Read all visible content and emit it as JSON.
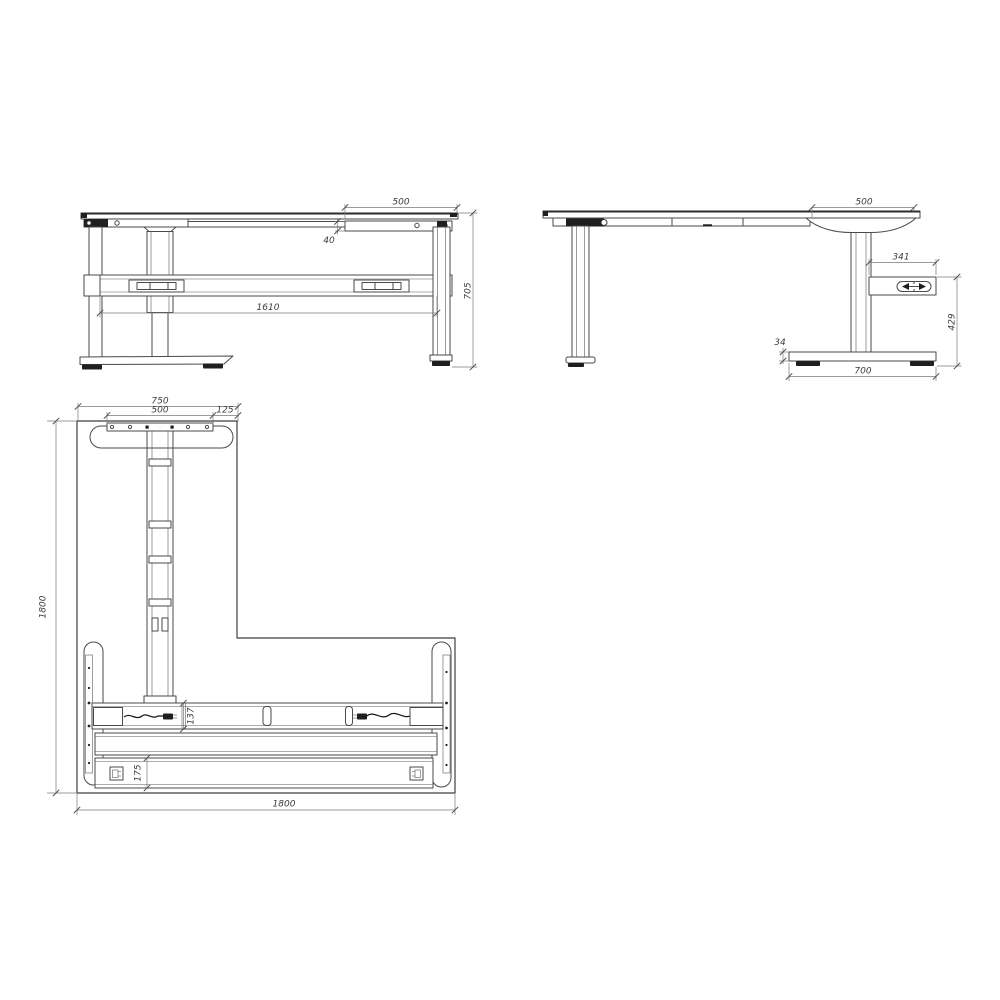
{
  "drawing": {
    "front_view": {
      "dims": {
        "right_overhang": "500",
        "frame_height": "40",
        "beam_length": "1610",
        "overall_height": "705"
      }
    },
    "side_view": {
      "dims": {
        "desktop_overhang": "500",
        "control_box_length": "341",
        "leg_height": "429",
        "foot_height": "34",
        "foot_length": "700"
      }
    },
    "plan_view": {
      "dims": {
        "return_width": "750",
        "foot_plate_width": "500",
        "edge_offset": "125",
        "return_length": "1800",
        "beam_depth": "137",
        "rail_depth": "175",
        "desk_length": "1800"
      }
    },
    "icons": {
      "height_adjust": "height-adjust-arrows-icon",
      "cable": "power-cable-connector-icon"
    },
    "colors": {
      "background": "#ffffff",
      "line": "#4a4a4a",
      "dim_line": "#7a7a7a",
      "dim_text": "#3c3c3c",
      "dark_fill": "#1f1f1f"
    }
  }
}
